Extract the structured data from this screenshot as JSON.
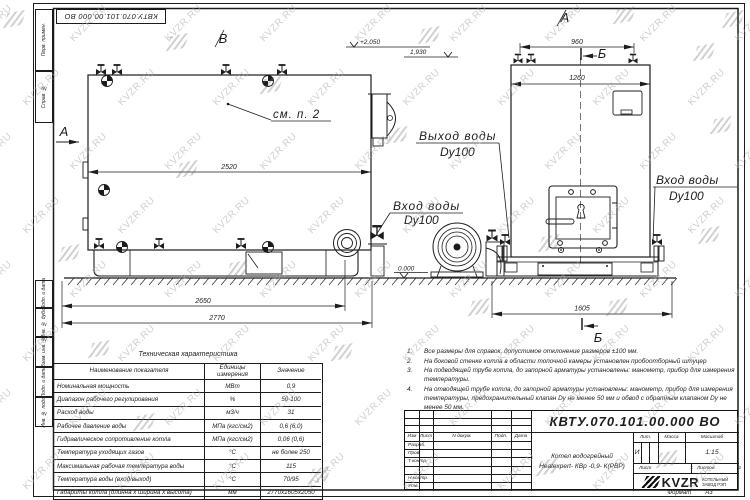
{
  "page": {
    "watermark_text": "KVZR.RU"
  },
  "stamp": {
    "doc_number": "КВТУ.070.101.00.000 ВО"
  },
  "frame": {
    "side_labels": [
      "Перв. примен.",
      "Справ. №",
      "Подп. и дата",
      "Инв. № дубл.",
      "Взам. инв. №",
      "Подп. и дата",
      "Инв. № подл."
    ],
    "format_label": "Формат",
    "format_value": "А3"
  },
  "drawing": {
    "section_a": "А",
    "section_b": "Б",
    "section_v": "В",
    "callout_see": "см. п. 2",
    "elev_top": "+2,050",
    "elev_mid": "1,930",
    "elev_zero": "0.000",
    "dim_2520": "2520",
    "dim_2650": "2650",
    "dim_2770": "2770",
    "dim_960": "960",
    "dim_1260": "1260",
    "dim_1605": "1605",
    "outlet_label": "Выход воды",
    "outlet_dn": "Dy100",
    "inlet_label": "Вход воды",
    "inlet_dn": "Dy100",
    "inlet_right_label": "Вход воды",
    "inlet_right_dn": "Dy100"
  },
  "notes": {
    "items": [
      {
        "num": "1.",
        "text": "Все размеры для справок, допустимое отклонение размеров ±100 мм."
      },
      {
        "num": "2.",
        "text": "На боковой стенке котла в области топочной камеры установлен пробоотборный штуцер"
      },
      {
        "num": "3.",
        "text": "На подводящей трубе котла, до запорной арматуры установлены: манометр, прибор для измерения температуры."
      },
      {
        "num": "4.",
        "text": "На отводящей трубе котла, до запорной арматуры установлены: манометр, прибор для измерения температуры, предохранительный клапан Dу не менее 50 мм и обвод с обратным клапаном Dу не менее 50 мм."
      }
    ]
  },
  "spec_table": {
    "title": "Техническая характеристика",
    "headers": [
      "Наименование показателя",
      "Единицы измерения",
      "Значение"
    ],
    "rows": [
      [
        "Номинальная мощность",
        "МВт",
        "0,9"
      ],
      [
        "Диапазон рабочего регулирования",
        "%",
        "50-100"
      ],
      [
        "Расход воды",
        "м3/ч",
        "31"
      ],
      [
        "Рабочее давление воды",
        "МПа (кгс/см2)",
        "0,6 (6,0)"
      ],
      [
        "Гидравлическое сопротивление котла",
        "МПа (кгс/см2)",
        "0,06 (0,6)"
      ],
      [
        "Температура уходящих газов",
        "°С",
        "не более 250"
      ],
      [
        "Максимальная рабочая температура воды",
        "°С",
        "115"
      ],
      [
        "Температура воды (вход/выход)",
        "°С",
        "70/95"
      ],
      [
        "Габариты котла (длинна х ширина х высота)",
        "мм",
        "2770х1605х2050"
      ]
    ]
  },
  "title_block": {
    "doc_number": "КВТУ.070.101.00.000 ВО",
    "columns": [
      "Изм",
      "Лист",
      "N докум.",
      "Подп.",
      "Дата"
    ],
    "row_labels": [
      "Разраб.",
      "Пров.",
      "Т.контр.",
      "",
      "Н.контр.",
      "Утв."
    ],
    "product_line1": "Котел водогрейный",
    "product_line2": "Heatexpert- КВр -0,9- К(РВР)",
    "lit_header": "Лит.",
    "mass_header": "Масса",
    "scale_header": "Масштаб",
    "lit_value": "И",
    "scale_value": "1:15",
    "sheet_label": "Лист",
    "sheet_value": "1",
    "sheets_label": "Листов",
    "sheets_value": "2",
    "brand": "KVZR",
    "brand_line1": "КОТЕЛЬНЫЙ",
    "brand_line2": "ЗАВОД РЭП"
  }
}
